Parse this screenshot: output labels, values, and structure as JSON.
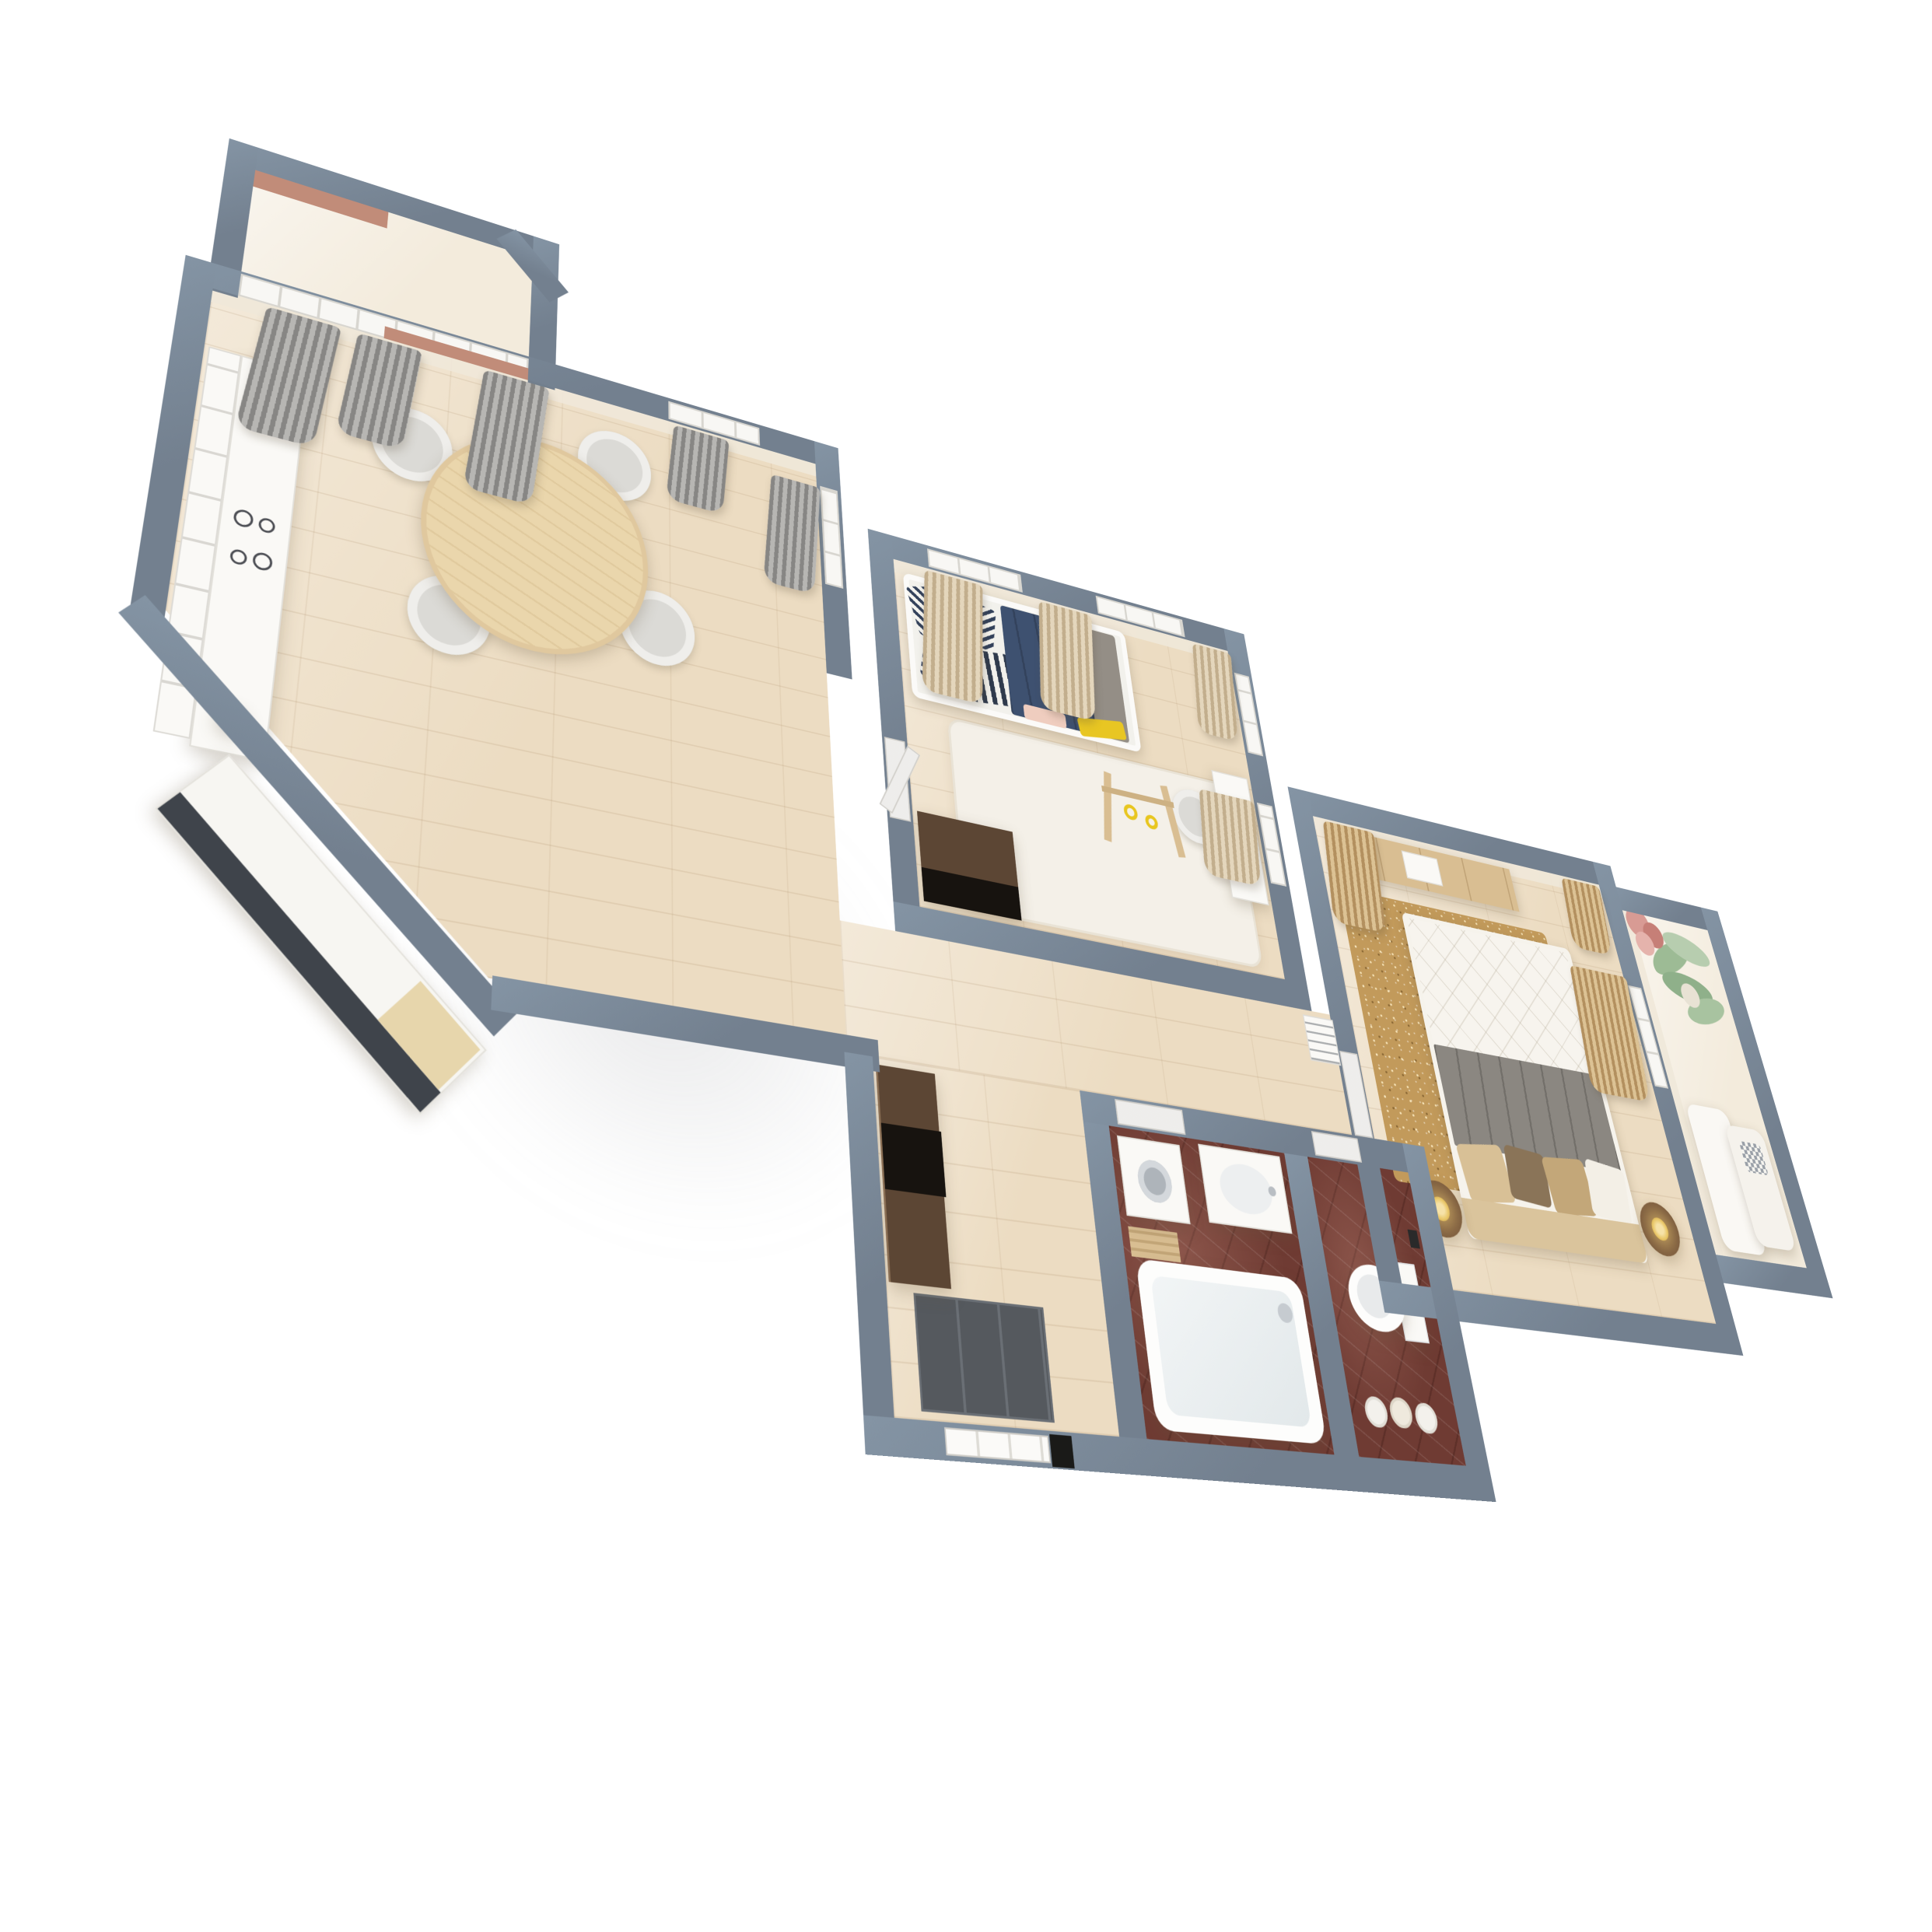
{
  "scene": {
    "type": "3d-apartment-floorplan-render",
    "style": "dollhouse perspective view, apartment rotated diagonally on white background",
    "background": "#FFFFFF",
    "visible_text": "none"
  },
  "palette": {
    "wall": "#73808F",
    "wall_light": "#8494A4",
    "wall_face": "#F0E8D9",
    "wood_floor": "#ECDCC2",
    "cream_floor": "#F3EBDC",
    "white_rug": "#F4F0E8",
    "bath_floor": "#6F3B33",
    "rug_gold": "#C29A5B",
    "curtain_gray": "#9A9997",
    "curtain_beige": "#D5C2A3",
    "curtain_gold": "#C9A97A",
    "furniture_white": "#FAF9F6",
    "wood_furniture": "#D9BE92",
    "dark_wardrobe": "#5C4634",
    "navy_blanket": "#3E5170",
    "gray_blanket": "#948E86",
    "yellow_accent": "#E8C623",
    "doormat": "#55595E",
    "brick": "#C18C79",
    "plant_green": "#9DBB95",
    "blossom_pink": "#D89B94",
    "headboard_tan": "#DAC49C",
    "table_wood": "#EAD6AC",
    "island_front": "#3F444B",
    "cooktop": "#23252A"
  },
  "rooms": [
    {
      "id": "kitchen-balcony",
      "name": "balcony off kitchen",
      "floor": "cream",
      "features": [
        "gray curtains",
        "brick parapet",
        "glazed window band"
      ]
    },
    {
      "id": "kitchen-dining",
      "name": "kitchen and dining room",
      "floor": "light wood",
      "furniture": [
        "white kitchen counter",
        "glass-front upper cabinets",
        "black cooktop",
        "counter island along diagonal wall",
        "white teapot",
        "round wooden dining table",
        "four gray tub chairs",
        "gray curtains"
      ]
    },
    {
      "id": "kids-room",
      "name": "kids room",
      "floor": "light wood with white rug",
      "furniture": [
        "white bed with navy blanket",
        "striped pillows",
        "yellow and pink throws",
        "dark wood chest",
        "wooden baby gym with yellow rings",
        "white desk and chair",
        "radiator-laptop detail",
        "beige curtains",
        "white interior door"
      ]
    },
    {
      "id": "hallway",
      "name": "hallway",
      "floor": "light wood",
      "furniture": [
        "dark brown wardrobe with open black niche",
        "dark gray entrance doormat",
        "white entrance door",
        "white AC unit"
      ]
    },
    {
      "id": "bathroom",
      "name": "bathroom",
      "floor": "maroon marble",
      "furniture": [
        "white bathtub with faucet",
        "washing machine",
        "white vanity with basin",
        "wooden slat mat"
      ]
    },
    {
      "id": "wc",
      "name": "separate WC",
      "floor": "maroon marble",
      "furniture": [
        "toilet with tank",
        "towel rolls",
        "paper holder"
      ]
    },
    {
      "id": "bedroom",
      "name": "master bedroom",
      "floor": "light wood with gold speckled rug",
      "furniture": [
        "double bed with white quilted duvet",
        "dark gray blanket",
        "tan and brown pillows",
        "tan headboard",
        "two round nightstands",
        "gold lamps",
        "wood dresser with white decor",
        "gold curtains",
        "white interior door"
      ]
    },
    {
      "id": "bedroom-balcony",
      "name": "loggia off bedroom",
      "floor": "cream",
      "furniture": [
        "white seat cushions",
        "checkered pillow",
        "green potted plant",
        "pink bouquet"
      ]
    }
  ]
}
